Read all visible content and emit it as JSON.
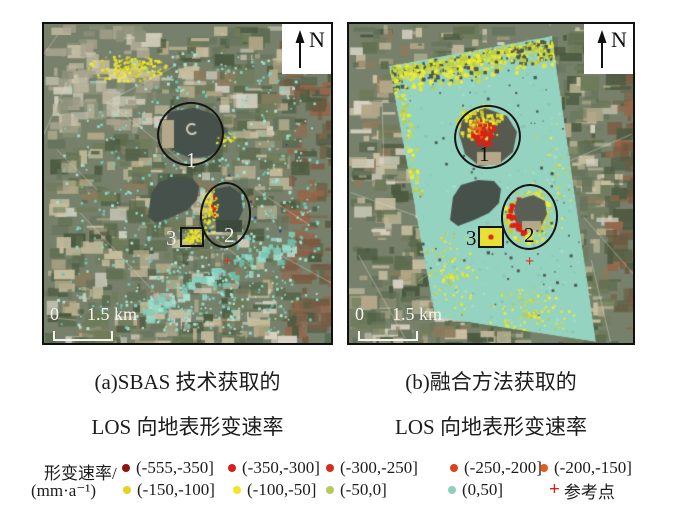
{
  "figure": {
    "panels": [
      {
        "id": "a",
        "north_label": "N",
        "scale_zero": "0",
        "scale_distance": "1.5 km",
        "region_labels": {
          "r1": "1",
          "r2": "2",
          "r3": "3"
        },
        "ref_marker": "+",
        "caption_line1": "(a)SBAS 技术获取的",
        "caption_line2": "LOS 向地表形变速率"
      },
      {
        "id": "b",
        "north_label": "N",
        "scale_zero": "0",
        "scale_distance": "1.5 km",
        "region_labels": {
          "r1": "1",
          "r2": "2",
          "r3": "3"
        },
        "ref_marker": "+",
        "caption_line1": "(b)融合方法获取的",
        "caption_line2": "LOS 向地表形变速率"
      }
    ]
  },
  "legend": {
    "title_line1": "形变速率/",
    "title_line2": "(mm·a⁻¹)",
    "rows": [
      [
        {
          "marker": "dot",
          "color": "#8e1410",
          "label": "(-555,-350]"
        },
        {
          "marker": "dot",
          "color": "#d42020",
          "label": "(-350,-300]"
        },
        {
          "marker": "dot",
          "color": "#d92b1b",
          "label": "(-300,-250]"
        },
        {
          "marker": "dot",
          "color": "#da441d",
          "label": "(-250,-200]"
        },
        {
          "marker": "dot",
          "color": "#e25c1e",
          "label": "(-200,-150]"
        }
      ],
      [
        {
          "marker": "dot",
          "color": "#e5d320",
          "label": "(-150,-100]"
        },
        {
          "marker": "dot",
          "color": "#f0e526",
          "label": "(-100,-50]"
        },
        {
          "marker": "dot",
          "color": "#b5c95c",
          "label": "(-50,0]"
        },
        {
          "marker": "dot",
          "color": "#8ecfbd",
          "label": "(0,50]"
        },
        {
          "marker": "cross",
          "color": "#d61f1a",
          "label": "参考点"
        }
      ]
    ]
  },
  "map_style": {
    "coverage_fill": "#95d3c1",
    "coverage_speckle_dark": "#85c7b3",
    "coverage_speckle_light": "#a7ddcc",
    "cyan_dots": [
      "#7fd0c0",
      "#96dcca",
      "#6fc4b2",
      "#aee4d4"
    ],
    "yellow_dots": [
      "#e9e133",
      "#d9cf2a",
      "#c9c832",
      "#f0ec30"
    ],
    "fringe_yellows": [
      "#e3e63a",
      "#f0ec30",
      "#ccd944",
      "#b9cc4a"
    ],
    "red_cluster": "#dd2113",
    "orange_cluster": "#e06a20",
    "navy_speck": "#2a3a8c",
    "dark_speck": "#4d574e",
    "lake_fill": "#47514b",
    "subsidence_blob": "#585a50",
    "shore_tan": "#b5a88a",
    "field_greens": [
      "#4a593f",
      "#5c6b4e",
      "#6e7b58",
      "#66735c",
      "#c8bf9f"
    ],
    "field_tans": [
      "#c7bda0",
      "#b3a787",
      "#8c7a5c",
      "#d7d2c4"
    ],
    "field_browns": [
      "#7c5a42",
      "#95664a",
      "#6b5a40",
      "#4e5c42"
    ],
    "urban_pales": [
      "#d3cdbc",
      "#c3bba4",
      "#a9a48f",
      "#8d9179"
    ],
    "road_line": "rgba(225,220,205,0.45)"
  }
}
